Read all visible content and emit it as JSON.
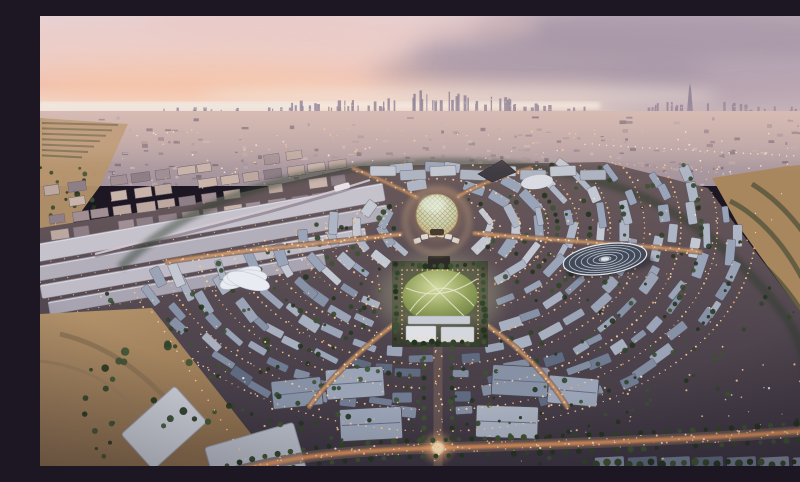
{
  "meta": {
    "description": "Aerial dusk rendering of the Expo 2020 Dubai master plan: a circular illuminated site with the Al Wasl lattice dome at its centre, a green garden plaza, radiating lit avenues, ring after ring of blue-grey pavilion roofs, long exhibition halls to the west, the Terra disc pavilion to the east, palm-lined boulevards, surrounding desert, and the distant Dubai skyline with the Burj Khalifa under a pink and mauve sunset sky.",
    "visible_text": "none"
  },
  "palette": {
    "sky_top": "#e5d5da",
    "sky_mid": "#f0d6cf",
    "sky_salmon": "#f3c0ab",
    "sky_horizon": "#f2e2d8",
    "cloud_gray": "#b3a3b2",
    "cloud_gray_dark": "#9f90a1",
    "cloud_pink": "#eac7c2",
    "sun_glow": "#f8c9a8",
    "sea": "#efe8e2",
    "skyline": "#94869a",
    "mid_top": "#cab1ad",
    "mid_bottom": "#a2929b",
    "sand_light": "#c1a078",
    "sand": "#ad8a62",
    "sand_dark": "#8f7250",
    "grove": "#55523a",
    "ground_top": "#6a5a5c",
    "ground_mid": "#564a52",
    "ground_bottom": "#3a3440",
    "light_warm": "#ffcf92",
    "light_orange": "#ffa85e",
    "light_white": "#fff3dd",
    "road_base": "#6f5b55",
    "road_core": "#f0a86a",
    "lawn_hi": "#ccd49a",
    "lawn": "#93a35c",
    "lawn_dark": "#66763f",
    "dome_hi": "#e9ecd8",
    "dome_mid": "#ccd2ac",
    "dome_gold": "#c89f6a",
    "lattice": "#8d7752",
    "terra_base": "#424a59",
    "terra_ring": "#c7cdd8",
    "white_pav": "#e8ebf1"
  },
  "lists": {
    "mid_building": [
      "#b9a6a6",
      "#a79399",
      "#c8b5b1",
      "#8f7f88",
      "#7c6f7b"
    ],
    "tree": [
      "#24351f",
      "#31452a",
      "#3d5232"
    ],
    "roof_high": [
      "#c3c8d2",
      "#aeb6c6",
      "#9aa4b8"
    ],
    "roof_mid": [
      "#9aa4b6",
      "#8791a6",
      "#a8b0c0"
    ],
    "roof_low": [
      "#707b92",
      "#5f6a80",
      "#828ca0"
    ],
    "hall": [
      "#c6c2cc",
      "#b2aeba",
      "#bfbbc6",
      "#a8a4b1"
    ],
    "apt": [
      "#bda8a0",
      "#a18f93",
      "#c9b4aa",
      "#8e7e86"
    ]
  },
  "scene": {
    "center": {
      "x": 397,
      "y": 212
    },
    "rings": [
      [
        52,
        30
      ],
      [
        78,
        46
      ],
      [
        104,
        62
      ],
      [
        132,
        82
      ],
      [
        162,
        104
      ],
      [
        194,
        128
      ],
      [
        228,
        150
      ],
      [
        262,
        170
      ],
      [
        298,
        190
      ]
    ],
    "counts": {
      "mid_buildings": 270,
      "mid_lights": 150,
      "scatter_lights": 280,
      "scatter_trees": 150
    },
    "horizon_y": 95
  },
  "clouds": [
    {
      "x": 620,
      "y": 38,
      "rx": 250,
      "ry": 48,
      "c": "cloud_gray",
      "o": 0.8,
      "f": "b14"
    },
    {
      "x": 745,
      "y": 78,
      "rx": 190,
      "ry": 55,
      "c": "cloud_gray",
      "o": 0.75,
      "f": "b14"
    },
    {
      "x": 500,
      "y": 55,
      "rx": 170,
      "ry": 36,
      "c": "cloud_gray_dark",
      "o": 0.5,
      "f": "b14"
    },
    {
      "x": 690,
      "y": 14,
      "rx": 260,
      "ry": 26,
      "c": "cloud_gray_dark",
      "o": 0.55,
      "f": "b8"
    },
    {
      "x": 130,
      "y": 30,
      "rx": 240,
      "ry": 36,
      "c": "cloud_pink",
      "o": 0.55,
      "f": "b14"
    },
    {
      "x": 300,
      "y": 10,
      "rx": 200,
      "ry": 20,
      "c": "cloud_pink",
      "o": 0.45,
      "f": "b8"
    },
    {
      "x": 150,
      "y": 68,
      "rx": 150,
      "ry": 20,
      "c": "sun_glow",
      "o": 0.55,
      "f": "b14"
    },
    {
      "x": 420,
      "y": 80,
      "rx": 260,
      "ry": 14,
      "c": "sky_horizon",
      "o": 0.6,
      "f": "b8"
    }
  ],
  "skyline": {
    "base_y": 96,
    "clusters": [
      {
        "x0": 120,
        "x1": 250,
        "n": 14,
        "h0": 2,
        "h1": 5
      },
      {
        "x0": 250,
        "x1": 345,
        "n": 22,
        "h0": 4,
        "h1": 12
      },
      {
        "x0": 345,
        "x1": 425,
        "n": 16,
        "h0": 8,
        "h1": 22
      },
      {
        "x0": 425,
        "x1": 470,
        "n": 10,
        "h0": 6,
        "h1": 16
      },
      {
        "x0": 470,
        "x1": 545,
        "n": 12,
        "h0": 3,
        "h1": 9
      },
      {
        "x0": 598,
        "x1": 705,
        "n": 18,
        "h0": 4,
        "h1": 10
      },
      {
        "x0": 705,
        "x1": 768,
        "n": 8,
        "h0": 2,
        "h1": 6
      }
    ],
    "burj": {
      "x": 650,
      "top": 67,
      "base": 96
    }
  },
  "landmarks": {
    "dome": {
      "cx": 397,
      "cy": 199,
      "r": 21
    },
    "terra": {
      "cx": 565,
      "cy": 243,
      "rx": 42,
      "ry": 15,
      "rings": 6,
      "tilt": -8
    },
    "park": {
      "x": 352,
      "y": 245,
      "w": 96,
      "h": 86
    },
    "uae_pavilion": {
      "cx": 205,
      "cy": 262
    },
    "boulevard": {
      "x": 398,
      "y0": 328,
      "y1": 452
    },
    "cross_road_y": 432
  }
}
